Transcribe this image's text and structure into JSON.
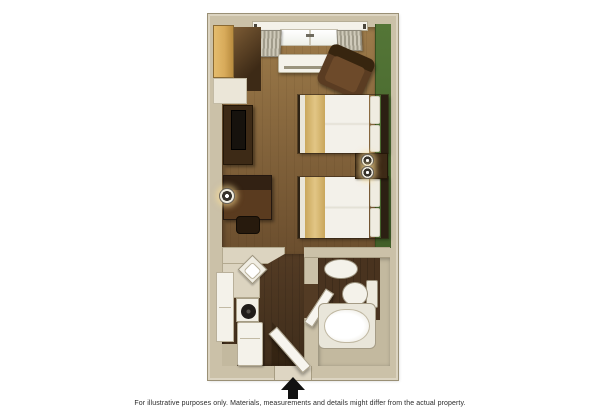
{
  "image": {
    "type": "hotel-studio-floor-plan",
    "disclaimer": "For illustrative purposes only.  Materials, measurements and details might differ from the actual property."
  },
  "palette": {
    "background": "#ffffff",
    "wall": "#cbc1a8",
    "wall-light": "#dcd4c1",
    "wall-line": "#9a9076",
    "green": "#547637",
    "green-dark": "#415f28",
    "floor-light": "#9d7b4a",
    "floor-dark": "#6b4e2e",
    "floor-lower": "#533b24",
    "floor-lower-dark": "#3f2d1b",
    "bath-wood": "#49331f",
    "tile": "#c3b99f",
    "counter": "#dcd4c0",
    "white-fixture": "#f4f2ea",
    "dark-wood": "#3d2a16",
    "darker-wood": "#271a0d",
    "desk-wood": "#5a3b1f",
    "amber": "#d8ab5b",
    "linen": "#f3f1ea",
    "runner": "#e2c685",
    "pillow": "#efece1",
    "curtain-a": "#cfcaba",
    "curtain-b": "#a19c8b",
    "armchair": "#5a3c22",
    "armchair-dark": "#37250f",
    "arrow": "#111111",
    "text": "#2b2b2b"
  },
  "floorplan": {
    "rooms": [
      "main-room",
      "kitchenette",
      "entry-hallway",
      "bathroom"
    ],
    "items": [
      "closet-door",
      "wardrobe",
      "shelf-counter",
      "tv-dresser",
      "flat-tv",
      "desk",
      "desk-chair",
      "desk-lamp",
      "window",
      "curtain-left",
      "curtain-right",
      "ptac-ac-unit",
      "armchair",
      "double-bed-1",
      "double-bed-2",
      "nightstand",
      "nightstand-lamp-1",
      "nightstand-lamp-2",
      "green-accent-wall",
      "kitchen-counter",
      "corner-sink",
      "tall-cabinet",
      "cooktop-stove",
      "refrigerator",
      "entry-door",
      "bathroom-door",
      "bathroom-sink",
      "toilet",
      "bathtub",
      "entry-arrow"
    ]
  }
}
